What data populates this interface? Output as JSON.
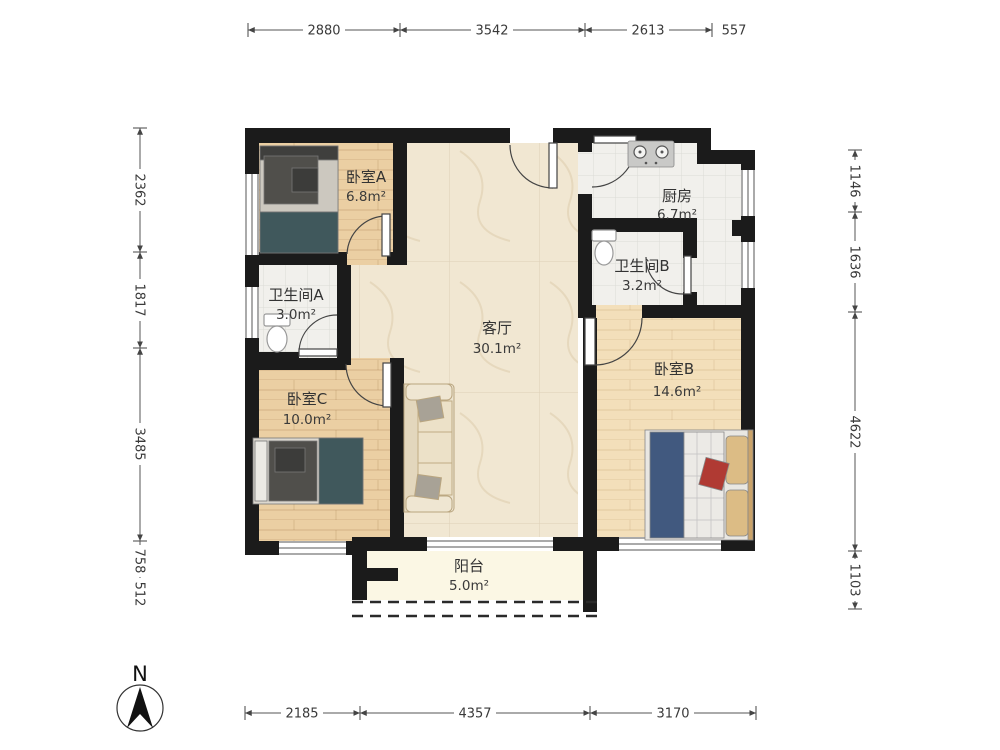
{
  "rooms": {
    "bedroomA": {
      "name": "卧室A",
      "area": "6.8m²"
    },
    "kitchen": {
      "name": "厨房",
      "area": "6.7m²"
    },
    "bathA": {
      "name": "卫生间A",
      "area": "3.0m²"
    },
    "bathB": {
      "name": "卫生间B",
      "area": "3.2m²"
    },
    "living": {
      "name": "客厅",
      "area": "30.1m²"
    },
    "bedroomB": {
      "name": "卧室B",
      "area": "14.6m²"
    },
    "bedroomC": {
      "name": "卧室C",
      "area": "10.0m²"
    },
    "balcony": {
      "name": "阳台",
      "area": "5.0m²"
    }
  },
  "dimensions": {
    "top": [
      "2880",
      "3542",
      "2613",
      "557"
    ],
    "left": [
      "2362",
      "1817",
      "3485",
      "758",
      "512"
    ],
    "right": [
      "1146",
      "1636",
      "4622",
      "1103"
    ],
    "bottom": [
      "2185",
      "4357",
      "3170"
    ]
  },
  "compass": {
    "label": "N"
  },
  "colors": {
    "wall": "#1b1b1b",
    "wood": "#ebcfa3",
    "wood_light": "#f3dfba",
    "marble": "#f1e7d2",
    "tile": "#f1f0ec",
    "balcony_floor": "#fbf7e4",
    "teal_blanket": "#40585c",
    "blue_blanket": "#41597f",
    "dim_text": "#3a3a3a"
  }
}
